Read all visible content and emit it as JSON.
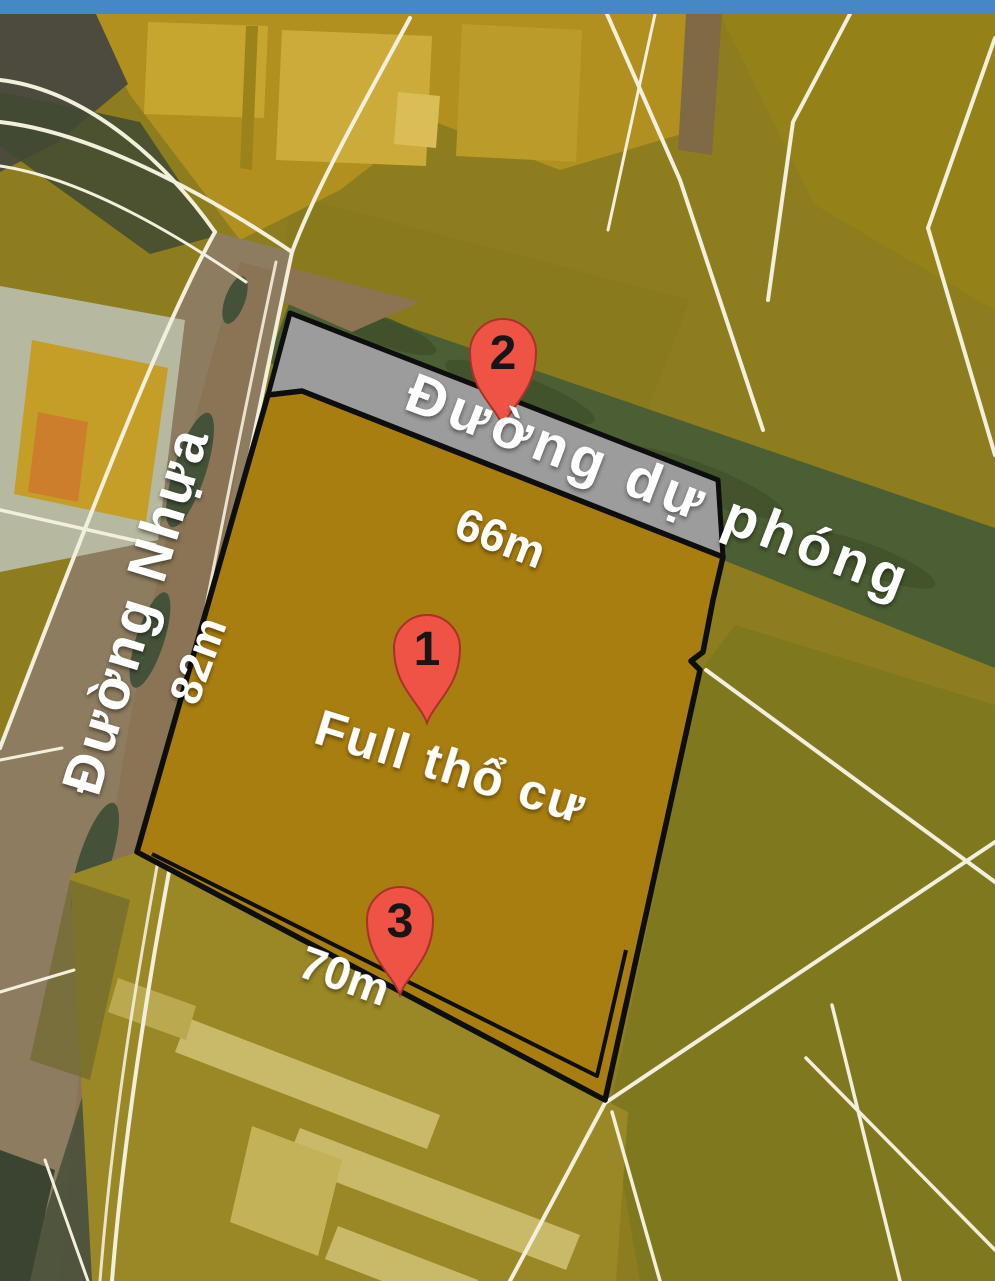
{
  "header": {
    "bar_color": "#4687c6"
  },
  "map": {
    "road_labels": {
      "planned_road": "Đường dự phóng",
      "asphalt_road": "Đường Nhựa"
    },
    "dimension_labels": {
      "planned_road_frontage": "66m",
      "left_side_depth": "82m",
      "bottom_frontage": "70m"
    },
    "parcel": {
      "status_label": "Full thổ cư",
      "fill_color": "#a87e10",
      "planned_strip_color": "#9c9c9c",
      "outline_color": "#0e0e0e"
    },
    "markers": [
      {
        "number": "1"
      },
      {
        "number": "2"
      },
      {
        "number": "3"
      }
    ],
    "marker_color": "#ee5345",
    "colors": {
      "field_olive": "#8d7d1f",
      "field_mustard": "#b1901f",
      "green_corridor": "#4c5e33",
      "road_surface": "#8d7c60",
      "boundary_line": "#f3efdd"
    }
  }
}
